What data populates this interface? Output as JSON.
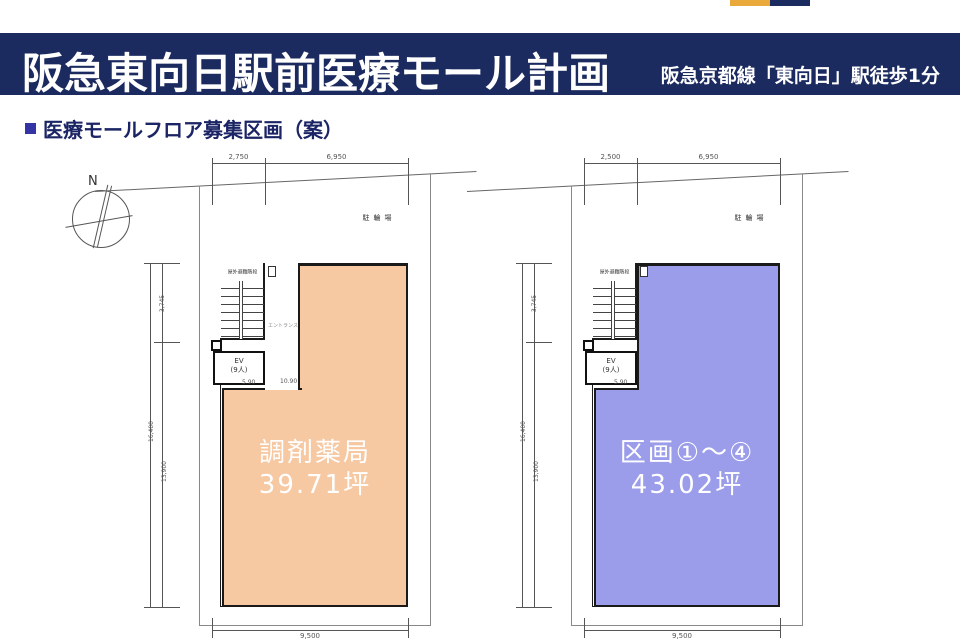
{
  "brand": {
    "navy": "#1B2A5F",
    "yellow": "#E9A93B",
    "heading_text": "#1B2464",
    "bullet_blue": "#3434A4"
  },
  "header": {
    "title": "阪急東向日駅前医療モール計画",
    "station_note": "阪急京都線「東向日」駅徒歩1分"
  },
  "section": {
    "heading": "医療モールフロア募集区画（案）"
  },
  "compass": {
    "north_label": "N"
  },
  "plans": [
    {
      "unit_label": "調剤薬局",
      "unit_area": "39.71坪",
      "fill": "#F6C9A3",
      "bicycle_parking": "駐輪場",
      "evac_stairs": "屋外避難階段",
      "elevator": "EV",
      "elevator_capacity": "(9人)",
      "corridor": "エントランス",
      "dim_top_1": "2,750",
      "dim_top_2": "6,950",
      "dim_bottom": "9,500",
      "dim_side_upper": "3,745",
      "dim_side_outer": "16,400",
      "dim_side_lower": "13,900",
      "dim_inner_1": "5.90",
      "dim_inner_2": "10.90"
    },
    {
      "unit_label": "区画①～④",
      "unit_area": "43.02坪",
      "fill": "#9B9CEA",
      "bicycle_parking": "駐輪場",
      "evac_stairs": "屋外避難階段",
      "elevator": "EV",
      "elevator_capacity": "(9人)",
      "dim_top_1": "2,500",
      "dim_top_2": "6,950",
      "dim_bottom": "9,500",
      "dim_side_upper": "3,745",
      "dim_side_outer": "16,400",
      "dim_side_lower": "13,900",
      "dim_inner_1": "5.90"
    }
  ]
}
